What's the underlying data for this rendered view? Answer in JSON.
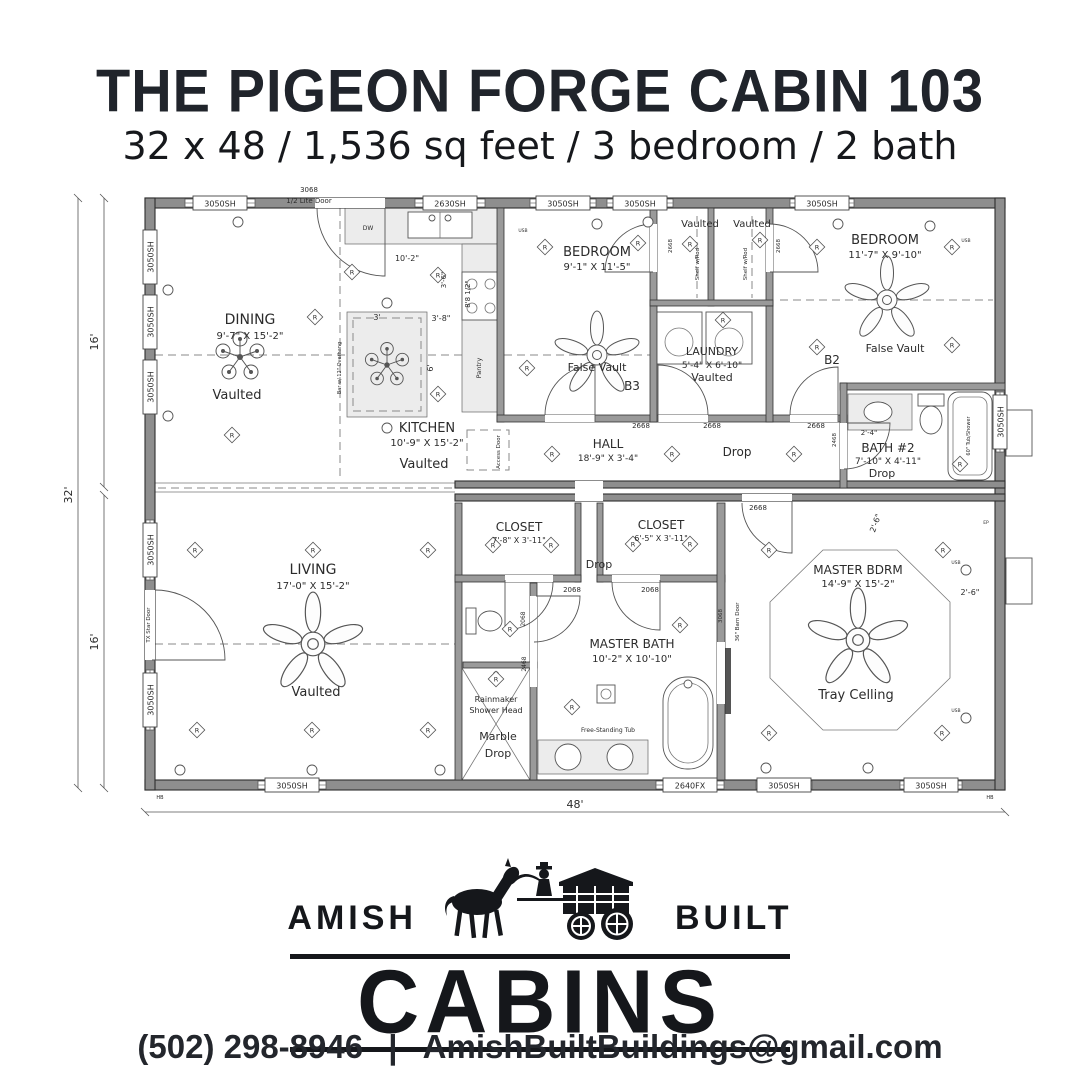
{
  "header": {
    "title": "THE PIGEON FORGE CABIN 103",
    "subtitle": "32 x 48 / 1,536 sq feet / 3 bedroom / 2 bath"
  },
  "logo": {
    "amish": "AMISH",
    "built": "BUILT",
    "cabins": "CABINS"
  },
  "contact": {
    "phone": "(502) 298-8946",
    "divider": "|",
    "email": "AmishBuiltBuildings@gmail.com"
  },
  "plan": {
    "texts": [
      {
        "t": "DINING",
        "x": 250,
        "y": 152,
        "s": 14
      },
      {
        "t": "9'-7\" X 15'-2\"",
        "x": 250,
        "y": 167,
        "s": 10
      },
      {
        "t": "Vaulted",
        "x": 237,
        "y": 227,
        "s": 13
      },
      {
        "t": "KITCHEN",
        "x": 427,
        "y": 260,
        "s": 13
      },
      {
        "t": "10'-9\" X 15'-2\"",
        "x": 427,
        "y": 274,
        "s": 10
      },
      {
        "t": "Vaulted",
        "x": 424,
        "y": 296,
        "s": 13
      },
      {
        "t": "BEDROOM",
        "x": 597,
        "y": 84,
        "s": 13
      },
      {
        "t": "9'-1\" X 11'-5\"",
        "x": 597,
        "y": 98,
        "s": 10
      },
      {
        "t": "False Vault",
        "x": 597,
        "y": 199,
        "s": 11
      },
      {
        "t": "B3",
        "x": 632,
        "y": 218,
        "s": 12
      },
      {
        "t": "HALL",
        "x": 608,
        "y": 276,
        "s": 12
      },
      {
        "t": "18'-9\" X 3'-4\"",
        "x": 608,
        "y": 289,
        "s": 9
      },
      {
        "t": "Drop",
        "x": 737,
        "y": 284,
        "s": 12
      },
      {
        "t": "Vaulted",
        "x": 700,
        "y": 55,
        "s": 10
      },
      {
        "t": "Vaulted",
        "x": 752,
        "y": 55,
        "s": 10
      },
      {
        "t": "Shelf w/Rod",
        "x": 699,
        "y": 92,
        "s": 5.5,
        "r": -90
      },
      {
        "t": "Shelf w/Rod",
        "x": 747,
        "y": 92,
        "s": 5.5,
        "r": -90
      },
      {
        "t": "LAUNDRY",
        "x": 712,
        "y": 183,
        "s": 11
      },
      {
        "t": "5'-4\" X 6'-10\"",
        "x": 712,
        "y": 196,
        "s": 9
      },
      {
        "t": "Vaulted",
        "x": 712,
        "y": 209,
        "s": 11
      },
      {
        "t": "BEDROOM",
        "x": 885,
        "y": 72,
        "s": 13
      },
      {
        "t": "11'-7\" X 9'-10\"",
        "x": 885,
        "y": 86,
        "s": 10
      },
      {
        "t": "False Vault",
        "x": 895,
        "y": 180,
        "s": 11
      },
      {
        "t": "B2",
        "x": 832,
        "y": 192,
        "s": 12
      },
      {
        "t": "BATH #2",
        "x": 888,
        "y": 280,
        "s": 12
      },
      {
        "t": "7'-10\" X 4'-11\"",
        "x": 888,
        "y": 292,
        "s": 9
      },
      {
        "t": "Drop",
        "x": 882,
        "y": 305,
        "s": 11
      },
      {
        "t": "2'-4\"",
        "x": 869,
        "y": 263,
        "s": 7
      },
      {
        "t": "60\" Tub/Shower",
        "x": 970,
        "y": 264,
        "s": 5,
        "r": -90
      },
      {
        "t": "LIVING",
        "x": 313,
        "y": 402,
        "s": 14
      },
      {
        "t": "17'-0\" X 15'-2\"",
        "x": 313,
        "y": 417,
        "s": 10
      },
      {
        "t": "Vaulted",
        "x": 316,
        "y": 524,
        "s": 13
      },
      {
        "t": "CLOSET",
        "x": 519,
        "y": 359,
        "s": 12
      },
      {
        "t": "7'-8\" X 3'-11\"",
        "x": 519,
        "y": 371,
        "s": 8
      },
      {
        "t": "CLOSET",
        "x": 661,
        "y": 357,
        "s": 12
      },
      {
        "t": "6'-5\" X 3'-11\"",
        "x": 661,
        "y": 369,
        "s": 8
      },
      {
        "t": "Drop",
        "x": 599,
        "y": 396,
        "s": 11
      },
      {
        "t": "2068",
        "x": 572,
        "y": 420,
        "s": 7
      },
      {
        "t": "2068",
        "x": 650,
        "y": 420,
        "s": 7
      },
      {
        "t": "2068",
        "x": 525,
        "y": 447,
        "s": 6,
        "r": -90
      },
      {
        "t": "2468",
        "x": 526,
        "y": 492,
        "s": 6,
        "r": -90
      },
      {
        "t": "MASTER BATH",
        "x": 632,
        "y": 476,
        "s": 12
      },
      {
        "t": "10'-2\" X 10'-10\"",
        "x": 632,
        "y": 490,
        "s": 10
      },
      {
        "t": "Free-Standing Tub",
        "x": 608,
        "y": 560,
        "s": 6
      },
      {
        "t": "Rainmaker",
        "x": 496,
        "y": 530,
        "s": 8
      },
      {
        "t": "Shower Head",
        "x": 496,
        "y": 541,
        "s": 8
      },
      {
        "t": "Marble",
        "x": 498,
        "y": 568,
        "s": 11
      },
      {
        "t": "Drop",
        "x": 498,
        "y": 585,
        "s": 11
      },
      {
        "t": "MASTER BDRM",
        "x": 858,
        "y": 402,
        "s": 12
      },
      {
        "t": "14'-9\" X 15'-2\"",
        "x": 858,
        "y": 415,
        "s": 10
      },
      {
        "t": "Tray Celling",
        "x": 856,
        "y": 527,
        "s": 13
      },
      {
        "t": "2'-6\"",
        "x": 878,
        "y": 352,
        "s": 8,
        "r": -70
      },
      {
        "t": "2'-6\"",
        "x": 970,
        "y": 423,
        "s": 8
      },
      {
        "t": "36\" Barn Door",
        "x": 739,
        "y": 450,
        "s": 5.5,
        "r": -90
      },
      {
        "t": "3068",
        "x": 722,
        "y": 444,
        "s": 5.5,
        "r": -90
      },
      {
        "t": "2668",
        "x": 641,
        "y": 256,
        "s": 7
      },
      {
        "t": "2668",
        "x": 712,
        "y": 256,
        "s": 7
      },
      {
        "t": "2668",
        "x": 816,
        "y": 256,
        "s": 7
      },
      {
        "t": "2668",
        "x": 672,
        "y": 74,
        "s": 5.5,
        "r": -90
      },
      {
        "t": "2668",
        "x": 780,
        "y": 74,
        "s": 5.5,
        "r": -90
      },
      {
        "t": "2668",
        "x": 758,
        "y": 338,
        "s": 7
      },
      {
        "t": "2468",
        "x": 836,
        "y": 268,
        "s": 5.5,
        "r": -90
      },
      {
        "t": "10'-2\"",
        "x": 407,
        "y": 89,
        "s": 8
      },
      {
        "t": "3'-6\"",
        "x": 446,
        "y": 108,
        "s": 7,
        "r": -90
      },
      {
        "t": "8'8 1/2\"",
        "x": 470,
        "y": 122,
        "s": 7,
        "r": -90
      },
      {
        "t": "3'-8\"",
        "x": 441,
        "y": 149,
        "s": 8
      },
      {
        "t": "3'",
        "x": 377,
        "y": 148,
        "s": 8
      },
      {
        "t": "6'",
        "x": 433,
        "y": 196,
        "s": 8,
        "r": -90
      },
      {
        "t": "Bar w/ 12\" Overhang",
        "x": 341,
        "y": 196,
        "s": 5,
        "r": -90
      },
      {
        "t": "Pantry",
        "x": 481,
        "y": 196,
        "s": 6.5,
        "r": -90
      },
      {
        "t": "Access Door",
        "x": 500,
        "y": 280,
        "s": 5.5,
        "r": -90
      },
      {
        "t": "DW",
        "x": 368,
        "y": 58,
        "s": 6
      },
      {
        "t": "3068",
        "x": 309,
        "y": 20,
        "s": 7
      },
      {
        "t": "1/2 Lite Door",
        "x": 309,
        "y": 31,
        "s": 7
      },
      {
        "t": "TX Star Door",
        "x": 150,
        "y": 453,
        "s": 5.5,
        "r": -90
      },
      {
        "t": "16'",
        "x": 98,
        "y": 170,
        "s": 11,
        "r": -90
      },
      {
        "t": "32'",
        "x": 72,
        "y": 323,
        "s": 11,
        "r": -90
      },
      {
        "t": "16'",
        "x": 98,
        "y": 470,
        "s": 11,
        "r": -90
      },
      {
        "t": "48'",
        "x": 575,
        "y": 636,
        "s": 11
      },
      {
        "t": "USB",
        "x": 523,
        "y": 60,
        "s": 4.5
      },
      {
        "t": "USB",
        "x": 966,
        "y": 70,
        "s": 4.5
      },
      {
        "t": "USB",
        "x": 956,
        "y": 392,
        "s": 4.5
      },
      {
        "t": "USB",
        "x": 956,
        "y": 540,
        "s": 4.5
      },
      {
        "t": "EP",
        "x": 986,
        "y": 352,
        "s": 4.5
      },
      {
        "t": "HB",
        "x": 160,
        "y": 627,
        "s": 5
      },
      {
        "t": "HB",
        "x": 990,
        "y": 627,
        "s": 5
      }
    ],
    "windows": [
      {
        "t": "3050SH",
        "x": 220,
        "y": 31,
        "o": "h",
        "g": 70
      },
      {
        "t": "2630SH",
        "x": 450,
        "y": 31,
        "o": "h",
        "g": 70
      },
      {
        "t": "3050SH",
        "x": 563,
        "y": 31,
        "o": "h",
        "g": 66
      },
      {
        "t": "3050SH",
        "x": 640,
        "y": 31,
        "o": "h",
        "g": 66
      },
      {
        "t": "3050SH",
        "x": 822,
        "y": 31,
        "o": "h",
        "g": 64
      },
      {
        "t": "3050SH",
        "x": 292,
        "y": 613,
        "o": "h",
        "g": 68
      },
      {
        "t": "2640FX",
        "x": 690,
        "y": 613,
        "o": "h",
        "g": 68
      },
      {
        "t": "3050SH",
        "x": 784,
        "y": 613,
        "o": "h",
        "g": 56
      },
      {
        "t": "3050SH",
        "x": 931,
        "y": 613,
        "o": "h",
        "g": 62
      },
      {
        "t": "3050SH",
        "x": 150,
        "y": 85,
        "o": "v",
        "g": 50
      },
      {
        "t": "3050SH",
        "x": 150,
        "y": 150,
        "o": "v",
        "g": 50
      },
      {
        "t": "3050SH",
        "x": 150,
        "y": 215,
        "o": "v",
        "g": 50
      },
      {
        "t": "3050SH",
        "x": 150,
        "y": 378,
        "o": "v",
        "g": 60
      },
      {
        "t": "3050SH",
        "x": 150,
        "y": 528,
        "o": "v",
        "g": 60
      },
      {
        "t": "3050SH",
        "x": 1000,
        "y": 250,
        "o": "v",
        "g": 60
      }
    ],
    "rlights": [
      [
        315,
        145
      ],
      [
        232,
        263
      ],
      [
        352,
        100
      ],
      [
        438,
        103
      ],
      [
        438,
        222
      ],
      [
        545,
        75
      ],
      [
        638,
        71
      ],
      [
        527,
        196
      ],
      [
        552,
        282
      ],
      [
        672,
        282
      ],
      [
        794,
        282
      ],
      [
        723,
        148
      ],
      [
        690,
        72
      ],
      [
        760,
        68
      ],
      [
        817,
        75
      ],
      [
        952,
        75
      ],
      [
        817,
        175
      ],
      [
        952,
        173
      ],
      [
        960,
        292
      ],
      [
        195,
        378
      ],
      [
        313,
        378
      ],
      [
        428,
        378
      ],
      [
        197,
        558
      ],
      [
        312,
        558
      ],
      [
        428,
        558
      ],
      [
        493,
        373
      ],
      [
        551,
        373
      ],
      [
        633,
        372
      ],
      [
        690,
        372
      ],
      [
        510,
        457
      ],
      [
        496,
        507
      ],
      [
        572,
        535
      ],
      [
        680,
        453
      ],
      [
        769,
        378
      ],
      [
        943,
        378
      ],
      [
        769,
        561
      ],
      [
        942,
        561
      ]
    ],
    "dots": [
      [
        238,
        50
      ],
      [
        597,
        52
      ],
      [
        648,
        50
      ],
      [
        838,
        52
      ],
      [
        930,
        54
      ],
      [
        168,
        118
      ],
      [
        168,
        244
      ],
      [
        387,
        131
      ],
      [
        387,
        256
      ],
      [
        180,
        598
      ],
      [
        312,
        598
      ],
      [
        440,
        598
      ],
      [
        766,
        596
      ],
      [
        868,
        596
      ],
      [
        966,
        398
      ],
      [
        966,
        546
      ]
    ]
  }
}
